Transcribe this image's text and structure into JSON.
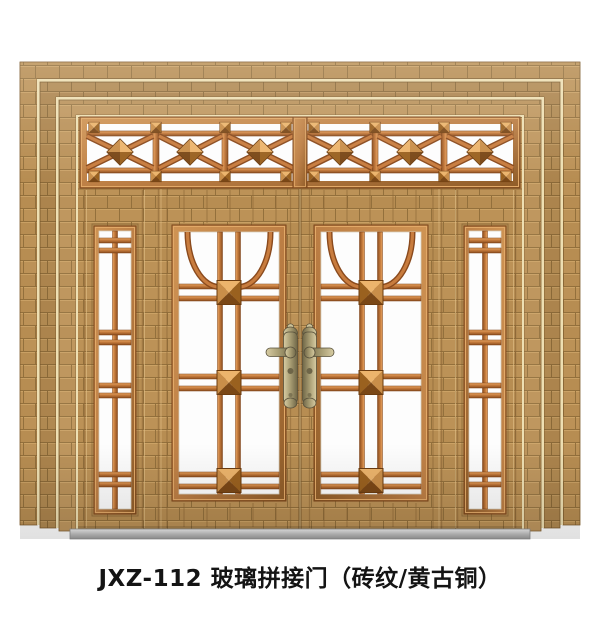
{
  "product": {
    "caption": "JXZ-112 玻璃拼接门（砖纹/黄古铜）",
    "model": "JXZ-112",
    "type_name": "玻璃拼接门",
    "finish": "砖纹/黄古铜"
  },
  "figure": {
    "components": [
      "stepped-outer-frame",
      "transom-x-lattice",
      "left-sidelight",
      "right-sidelight",
      "left-door-leaf",
      "right-door-leaf",
      "lever-handles",
      "threshold"
    ]
  },
  "palette": {
    "background": "#ffffff",
    "wood": "#b78d52",
    "wood_grout": "#93703c",
    "wood_highlight": "#d2ab6d",
    "copper_bar": "#c47a3c",
    "copper_dark": "#8a4d1e",
    "copper_light": "#eaa763",
    "glass": "#fdfdfd",
    "hardware_brass": "#a79c72",
    "threshold_gray": "#c2c2c2",
    "caption_text": "#141414"
  }
}
